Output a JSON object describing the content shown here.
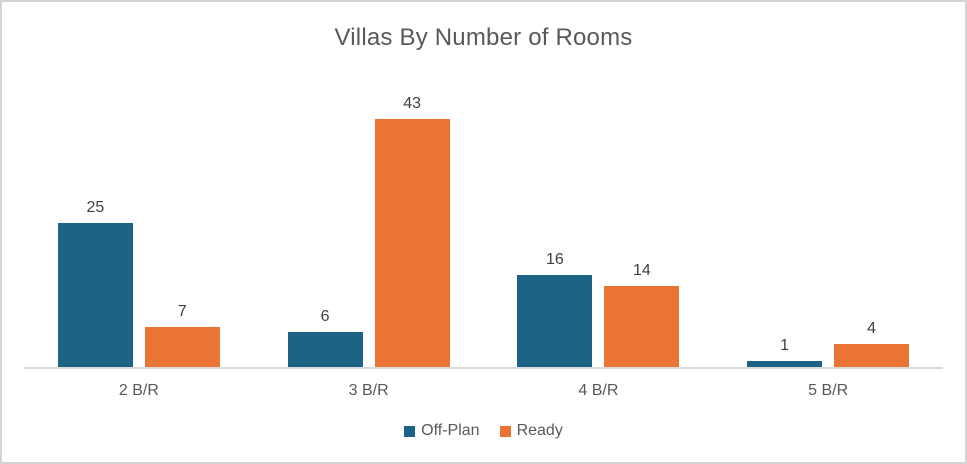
{
  "chart_data": {
    "type": "bar",
    "title": "Villas By Number of Rooms",
    "categories": [
      "2 B/R",
      "3 B/R",
      "4 B/R",
      "5 B/R"
    ],
    "series": [
      {
        "name": "Off-Plan",
        "color": "#1C6385",
        "values": [
          25,
          6,
          16,
          1
        ]
      },
      {
        "name": "Ready",
        "color": "#EA7434",
        "values": [
          7,
          43,
          14,
          4
        ]
      }
    ],
    "ylim": [
      0,
      50
    ],
    "grid": false,
    "y_axis_visible": false,
    "data_labels": true,
    "legend_position": "bottom",
    "colors": {
      "title_text": "#595959",
      "data_label_text": "#404040",
      "category_label_text": "#595959",
      "axis_line": "#D9D9D9",
      "frame_border": "#D3D3D3",
      "background": "#FFFFFF"
    }
  }
}
